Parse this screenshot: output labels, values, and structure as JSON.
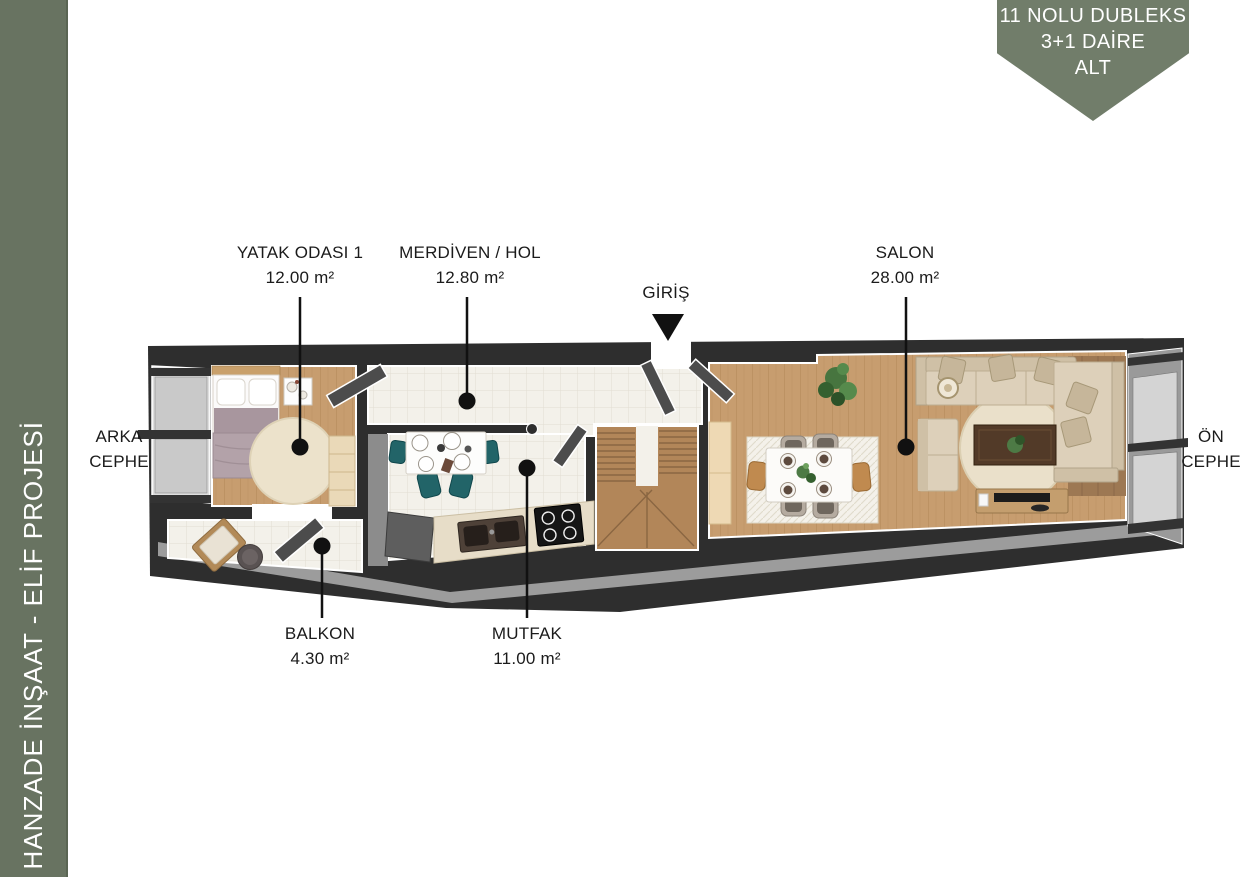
{
  "badge": {
    "line1": "11 NOLU DUBLEKS",
    "line2": "3+1 DAİRE",
    "line3": "ALT"
  },
  "sidebar": {
    "text": "HANZADE İNŞAAT - ELİF PROJESİ"
  },
  "labels": {
    "yatak": {
      "name": "YATAK ODASI 1",
      "area": "12.00 m²"
    },
    "merdiven": {
      "name": "MERDİVEN / HOL",
      "area": "12.80 m²"
    },
    "salon": {
      "name": "SALON",
      "area": "28.00 m²"
    },
    "balkon": {
      "name": "BALKON",
      "area": "4.30 m²"
    },
    "mutfak": {
      "name": "MUTFAK",
      "area": "11.00 m²"
    },
    "giris": {
      "name": "GİRİŞ"
    },
    "arka_cephe": {
      "line1": "ARKA",
      "line2": "CEPHE"
    },
    "on_cephe": {
      "line1": "ÖN",
      "line2": "CEPHE"
    }
  },
  "colors": {
    "sidebar_green": "#687361",
    "badge_green": "#717d6a",
    "wall_dark": "#2e2e2e",
    "wood_floor": "#c79d6f",
    "stair_wood": "#b28659",
    "tile": "#f3f1ea",
    "rug_cream": "#eae0ca",
    "sofa_beige": "#ddd0ba",
    "bed_mauve": "#a8969e",
    "chair_teal": "#226468",
    "glass_gray": "#c9c9c9"
  }
}
